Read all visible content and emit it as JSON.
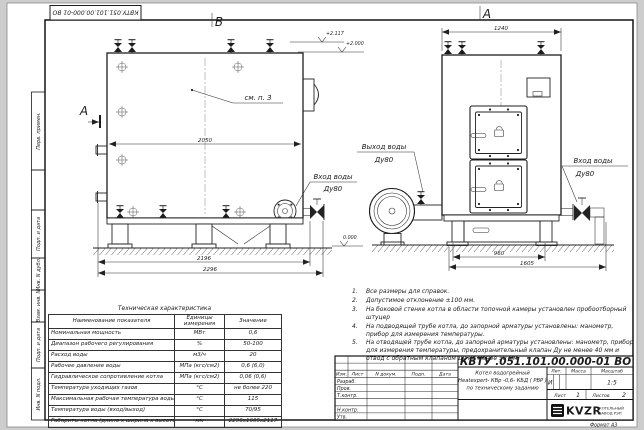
{
  "stamp_top": "КВТУ.051.101.00.000-01  ВО",
  "margin": {
    "m1": "Перв. примен.",
    "m3": "Подп. и дата",
    "m4": "Инв. N дубл.",
    "m5": "Взам. инв. N",
    "m6": "Подп. и дата",
    "m7": "Инв. N подл."
  },
  "drawing": {
    "view_b": "В",
    "view_a": "А",
    "section_a": "А",
    "see_note": "см. п. 3",
    "elev_top": "+2.117",
    "elev_mid": "+2.000",
    "elev_zero": "0.000",
    "dim_2050": "2050",
    "dim_2196": "2196",
    "dim_2296": "2296",
    "dim_1240": "1240",
    "dim_960": "960",
    "dim_1605": "1605",
    "labels": {
      "outlet_line1": "Выход воды",
      "outlet_line2": "Ду80",
      "inlet_left_line1": "Вход воды",
      "inlet_left_line2": "Ду80",
      "inlet_right_line1": "Вход воды",
      "inlet_right_line2": "Ду80"
    }
  },
  "tech": {
    "title": "Техническая характеристика",
    "col_name": "Наименование показателя",
    "col_unit": "Единицы измерения",
    "col_value": "Значение",
    "rows": [
      {
        "name": "Номинальная мощность",
        "unit": "МВт",
        "value": "0,6"
      },
      {
        "name": "Диапазон рабочего регулирования",
        "unit": "%",
        "value": "50-100"
      },
      {
        "name": "Расход воды",
        "unit": "м3/ч",
        "value": "20"
      },
      {
        "name": "Рабочее давление воды",
        "unit": "МПа (кгс/см2)",
        "value": "0,6 (6,0)"
      },
      {
        "name": "Гидравлическое сопротивление котла",
        "unit": "МПа (кгс/см2)",
        "value": "0,06 (0,6)"
      },
      {
        "name": "Температура уходящих газов",
        "unit": "°С",
        "value": "не более 220"
      },
      {
        "name": "Максимальная рабочая температура воды",
        "unit": "°С",
        "value": "115"
      },
      {
        "name": "Температура воды (вход/выход)",
        "unit": "°С",
        "value": "70/95"
      },
      {
        "name": "Габариты котла (длина х ширина х высота)",
        "unit": "мм",
        "value": "2296х1605х2117"
      }
    ]
  },
  "notes": [
    {
      "num": "1.",
      "text": "Все размеры для справок."
    },
    {
      "num": "2.",
      "text": "Допустимое отклонение ±100 мм."
    },
    {
      "num": "3.",
      "text": "На боковой стенке котла в области топочной камеры установлен пробоотборный штуцер"
    },
    {
      "num": "4.",
      "text": "На подводящей трубе котла, до запорной арматуры установлены: манометр, прибор для измерения температуры."
    },
    {
      "num": "5.",
      "text": "На отводящей трубе котла, до запорной арматуры установлены: манометр, прибор для измерения температуры, предохранительный клапан Ду не менее 40 мм и отвод с обратным клапаном Ду не менее 50 мм."
    }
  ],
  "tb": {
    "doc": "КВТУ .051.101.00.000-01  ВО",
    "h_izm": "Изм.",
    "h_list": "Лист",
    "h_doc": "N докум.",
    "h_podp": "Подп.",
    "h_data": "Дата",
    "r1": "Разраб.",
    "r2": "Пров.",
    "r3": "Т.контр.",
    "r4": "Н.контр.",
    "r5": "Утв.",
    "name1": "Котел водогрейный",
    "name2": "Heatexpert- КВр -0,6- КБД ( РВР )",
    "name3": "по техническому заданию",
    "h_lit": "Лит.",
    "h_mass": "Масса",
    "h_scale": "Масштаб",
    "lit": "И",
    "scale": "1:5",
    "sheet_label": "Лист",
    "sheet_no": "1",
    "sheets_label": "Листов",
    "sheets_no": "2",
    "logo": "KVZR",
    "org1": "КОТЕЛЬНЫЙ",
    "org2": "ЗАВОД РЭП",
    "format": "Формат  А3"
  }
}
